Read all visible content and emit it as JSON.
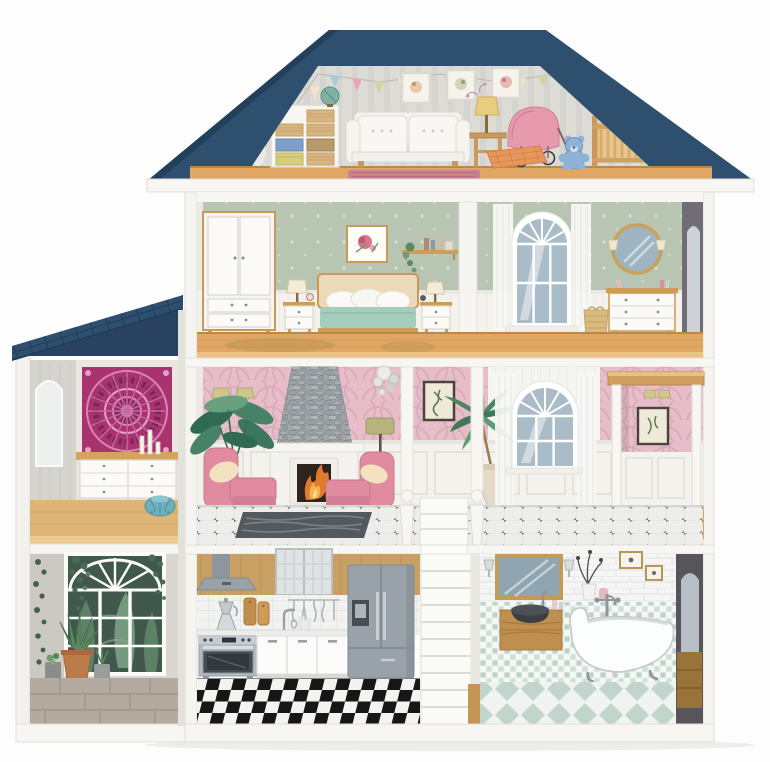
{
  "image": {
    "type": "product-illustration",
    "subject": "Wooden dollhouse cross-section with furnished rooms",
    "description": "Three-storey dollhouse with flat-topped navy gable roof, left annex with mono-pitch navy roof, white facade edges, fully furnished interior rooms shown in cutaway view"
  },
  "palette": {
    "roof": "#2e4f6e",
    "roof_fascia": "#28425f",
    "attic_wall": "#dcdbd6",
    "sage_wall": "#b9c5b3",
    "pink_wall": "#e6bdc9",
    "wainscot": "#f3f2ec",
    "wood_floor": "#dfa763",
    "wood_trim": "#cf9c55",
    "kitchen_wood": "#c9a063",
    "fridge_gray": "#9aa2a9",
    "armchair_pink": "#e08ba0",
    "pram_pink": "#e79aad",
    "teddy_blue": "#8fb3d6",
    "bed_blanket": "#a5cdbb",
    "pouf_teal": "#6fb0bf",
    "mandala_magenta": "#a8336f",
    "tub_white": "#fcfdfd",
    "fire_orange": "#e2792f",
    "foliage_green": "#41584d",
    "glass_blue": "#a9bcc8",
    "stone_floor": "#b3ab9f",
    "rug_dark": "#54595e",
    "rug_rose": "#c98090"
  },
  "rooms": [
    {
      "id": "attic-playroom",
      "name": "Attic playroom",
      "level": "attic",
      "items": [
        "bunting flags",
        "three picture frames",
        "storage shelf with wicker baskets",
        "globe",
        "white two-seat sofa",
        "side table with lamp",
        "pink pram",
        "plaid cushion",
        "blue teddy bear",
        "wooden crib",
        "rose rug"
      ]
    },
    {
      "id": "bedroom",
      "name": "Bedroom",
      "level": "second",
      "items": [
        "white wardrobe",
        "two nightstands with lamps",
        "double bed with teal blanket",
        "floral picture",
        "hanging shelf with plant"
      ]
    },
    {
      "id": "dressing-room",
      "name": "Dressing room",
      "level": "second",
      "items": [
        "arched window with sheer curtains",
        "round mirror with sconces",
        "three-drawer dresser",
        "wicker basket"
      ]
    },
    {
      "id": "living-room",
      "name": "Living room",
      "level": "first",
      "items": [
        "stone chimney fireplace",
        "two pink armchairs",
        "large houseplant",
        "wall sconce",
        "floor lamp",
        "pendant cluster",
        "framed print",
        "palm in vase",
        "arched window",
        "tiled floor with dark rug"
      ]
    },
    {
      "id": "lift-nook",
      "name": "Lift nook",
      "level": "first",
      "items": [
        "wooden canopy",
        "framed botanical print",
        "wall sconce",
        "panelled wainscot"
      ]
    },
    {
      "id": "boudoir",
      "name": "Annex boudoir",
      "level": "first",
      "items": [
        "magenta mandala tapestry",
        "white six-drawer sideboard",
        "candles",
        "teal pouf"
      ]
    },
    {
      "id": "winter-garden",
      "name": "Winter garden",
      "level": "ground",
      "items": [
        "arched garden window",
        "hanging plants",
        "agave in terracotta pot",
        "potted succulents",
        "stone floor"
      ]
    },
    {
      "id": "kitchen",
      "name": "Kitchen",
      "level": "ground",
      "items": [
        "range hood",
        "glass cabinet",
        "stainless range oven",
        "white cabinets",
        "gray fridge with ice dispenser",
        "moka pot",
        "hanging utensils",
        "checkered floor"
      ]
    },
    {
      "id": "staircase",
      "name": "Staircase",
      "level": "ground",
      "items": [
        "white steps",
        "turned newel posts"
      ]
    },
    {
      "id": "bathroom",
      "name": "Bathroom",
      "level": "ground",
      "items": [
        "framed mirror",
        "wall sconces",
        "floating wood vanity",
        "dark vessel sink",
        "clawfoot bathtub",
        "mosaic wall",
        "diamond tile floor"
      ]
    }
  ]
}
